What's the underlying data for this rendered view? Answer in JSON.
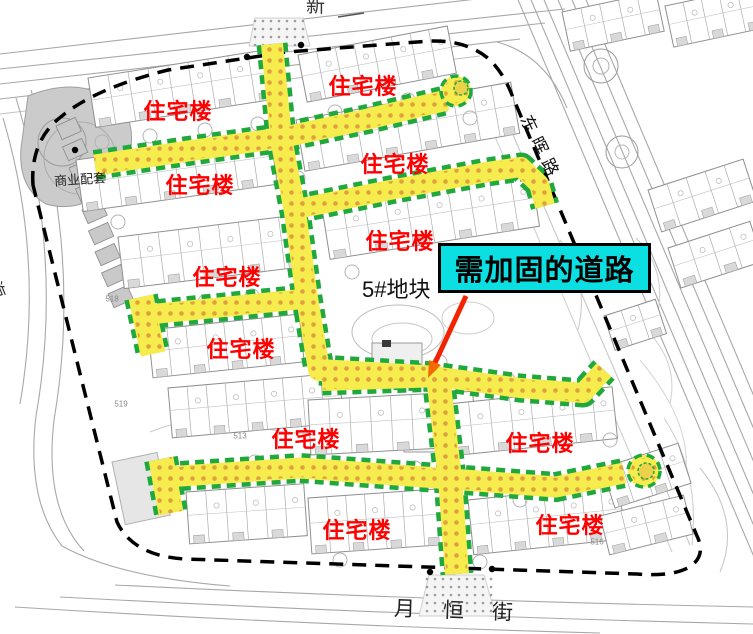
{
  "callout": {
    "label": "需加固的道路",
    "bg": "#0bdfe2",
    "border": "#000000"
  },
  "plot_label": "5#地块",
  "labels": {
    "residential": "住宅楼",
    "residential_color": "#fe0000",
    "residential_positions": [
      [
        178,
        110
      ],
      [
        363,
        85
      ],
      [
        200,
        184
      ],
      [
        395,
        163
      ],
      [
        227,
        276
      ],
      [
        400,
        240
      ],
      [
        241,
        348
      ],
      [
        306,
        438
      ],
      [
        540,
        442
      ],
      [
        357,
        529
      ],
      [
        570,
        524
      ]
    ],
    "commercial": "商业配套",
    "small_labels": [
      {
        "t": "518",
        "x": 112,
        "y": 299
      },
      {
        "t": "519",
        "x": 121,
        "y": 404
      },
      {
        "t": "513",
        "x": 240,
        "y": 436
      },
      {
        "t": "516",
        "x": 597,
        "y": 542
      }
    ]
  },
  "streets": {
    "right": "东晖路",
    "left": "滨海",
    "bottom": "月恒街",
    "top_partial": "新"
  },
  "map": {
    "colors": {
      "road_fill": "#f6ec4e",
      "road_edge": "#1fa83e",
      "road_dot": "#dfa13d",
      "boundary": "#000000",
      "building_stroke": "#8f8f8f",
      "bg_line": "#a8a8a8",
      "arrow": "#f32200",
      "arrow_head": "#f26a00"
    },
    "roads": [
      {
        "d": "M272,44 L281,138 L295,212 L307,298 L319,370 L438,377",
        "w": 22
      },
      {
        "d": "M438,377 L450,478 L457,574",
        "w": 24
      },
      {
        "d": "M95,165 L188,151 L280,138 L368,119 L447,100",
        "w": 21
      },
      {
        "d": "M297,209 L390,190 L487,172 L521,167 L539,184 L545,206",
        "w": 20
      },
      {
        "d": "M143,315 L224,307 L302,299",
        "w": 20
      },
      {
        "d": "M141,297 L153,354",
        "w": 25
      },
      {
        "d": "M322,381 L440,377 L520,388 L583,393 L604,370",
        "w": 20
      },
      {
        "d": "M166,477 L300,468 L438,478 L556,487 L624,473",
        "w": 21
      },
      {
        "d": "M161,459 L171,513",
        "w": 25
      }
    ],
    "bulbs": [
      {
        "cx": 456,
        "cy": 91,
        "r": 15,
        "ix": 461,
        "iy": 88,
        "ir": 7
      },
      {
        "cx": 644,
        "cy": 471,
        "r": 16,
        "ix": 646,
        "iy": 471,
        "ir": 8
      }
    ],
    "rows": [
      [
        88,
        78,
        182,
        50,
        9,
        -9
      ],
      [
        76,
        160,
        196,
        52,
        10,
        -8
      ],
      [
        118,
        237,
        182,
        52,
        9,
        -7
      ],
      [
        148,
        330,
        152,
        48,
        8,
        -6
      ],
      [
        168,
        388,
        172,
        50,
        9,
        -5
      ],
      [
        186,
        492,
        118,
        52,
        6,
        -4
      ],
      [
        308,
        498,
        132,
        56,
        7,
        -4
      ],
      [
        468,
        500,
        152,
        55,
        8,
        -6
      ],
      [
        298,
        55,
        152,
        48,
        8,
        -11
      ],
      [
        296,
        120,
        218,
        52,
        11,
        -10
      ],
      [
        322,
        208,
        212,
        52,
        10,
        -9
      ],
      [
        308,
        400,
        165,
        55,
        8,
        -3
      ],
      [
        448,
        404,
        165,
        52,
        8,
        -6
      ],
      [
        562,
        12,
        96,
        40,
        5,
        -12
      ],
      [
        665,
        6,
        92,
        42,
        5,
        -12
      ],
      [
        648,
        190,
        100,
        44,
        5,
        -18
      ],
      [
        668,
        248,
        86,
        42,
        4,
        -18
      ],
      [
        604,
        316,
        54,
        36,
        3,
        -18
      ],
      [
        602,
        468,
        80,
        42,
        4,
        -18
      ],
      [
        600,
        516,
        86,
        40,
        4,
        -14
      ]
    ],
    "shapes": [
      {
        "t": "path",
        "d": "M28,96 Q88,72 126,112 Q142,150 112,186 Q80,214 46,204 Q18,188 21,148 Z",
        "f": "#cbcbcb",
        "s": "#9e9e9e"
      },
      {
        "t": "circle",
        "cx": 62,
        "cy": 142,
        "r": 24,
        "s": "#9b9b9b"
      },
      {
        "t": "circle",
        "cx": 80,
        "cy": 158,
        "r": 36,
        "s": "#ababab"
      },
      {
        "t": "strip",
        "x": 56,
        "y": 126,
        "n": 9,
        "dx": 6.5,
        "dy": 21,
        "w": 21,
        "h": 15,
        "a": -24,
        "f": "#c9c9c9",
        "s": "#8a8a8a"
      },
      {
        "t": "ellipse",
        "cx": 398,
        "cy": 332,
        "rx": 46,
        "ry": 27,
        "s": "#bdbdbd"
      },
      {
        "t": "ellipse",
        "cx": 402,
        "cy": 339,
        "rx": 30,
        "ry": 16,
        "s": "#c6c6c6"
      },
      {
        "t": "ellipse",
        "cx": 468,
        "cy": 318,
        "rx": 26,
        "ry": 16,
        "s": "#cecece"
      },
      {
        "t": "rect",
        "x": 372,
        "y": 343,
        "w": 50,
        "h": 22,
        "f": "#efefef",
        "s": "#9a9a9a"
      },
      {
        "t": "rect",
        "x": 382,
        "y": 340,
        "w": 9,
        "h": 7,
        "f": "#3a3a3a"
      },
      {
        "t": "rect",
        "x": 404,
        "y": 428,
        "w": 38,
        "h": 24,
        "f": "#f1f1f1",
        "s": "#9a9a9a"
      },
      {
        "t": "circle",
        "cx": 601,
        "cy": 66,
        "r": 17,
        "s": "#9a9a9a"
      },
      {
        "t": "circle",
        "cx": 601,
        "cy": 66,
        "r": 8,
        "s": "#b2b2b2"
      },
      {
        "t": "circle",
        "cx": 622,
        "cy": 152,
        "r": 16,
        "s": "#9a9a9a"
      },
      {
        "t": "circle",
        "cx": 622,
        "cy": 152,
        "r": 7,
        "s": "#b7b7b7"
      },
      {
        "t": "rect",
        "x": 112,
        "y": 462,
        "w": 46,
        "h": 64,
        "f": "#e6e6e6",
        "s": "#b0b0b0",
        "a": -12
      },
      {
        "t": "path",
        "d": "M150,432 Q205,410 255,426 Q300,438 332,430",
        "s": "#c9c9c9"
      }
    ],
    "trees": [
      [
        102,
        142
      ],
      [
        150,
        136
      ],
      [
        205,
        130
      ],
      [
        258,
        124
      ],
      [
        335,
        112
      ],
      [
        408,
        100
      ],
      [
        470,
        118
      ],
      [
        298,
        178
      ],
      [
        252,
        296
      ],
      [
        205,
        302
      ],
      [
        352,
        272
      ],
      [
        300,
        256
      ],
      [
        440,
        362
      ],
      [
        508,
        380
      ],
      [
        560,
        392
      ],
      [
        255,
        462
      ],
      [
        345,
        470
      ],
      [
        480,
        562
      ],
      [
        415,
        468
      ],
      [
        610,
        440
      ],
      [
        118,
        222
      ],
      [
        340,
        560
      ],
      [
        520,
        500
      ]
    ],
    "bg_lines": [
      {
        "d": "M0,99 L520,39"
      },
      {
        "d": "M0,84 L545,23"
      },
      {
        "d": "M0,69 L565,9"
      },
      {
        "d": "M0,54 L520,-6"
      },
      {
        "d": "M0,114 L480,56",
        "c": "#c2c2c2"
      },
      {
        "d": "M497,42 Q545,55 567,108"
      },
      {
        "d": "M516,-5 L768,590"
      },
      {
        "d": "M529,-5 L781,590"
      },
      {
        "d": "M542,-5 L794,590"
      },
      {
        "d": "M556,-5 L808,590"
      },
      {
        "d": "M570,-5 L822,590"
      },
      {
        "d": "M584,-5 L836,590"
      },
      {
        "d": "M498,100 L690,545",
        "c": "#c6c6c6"
      },
      {
        "d": "M482,106 L672,552",
        "c": "#d0d0d0"
      },
      {
        "d": "M115,585 Q420,600 753,607"
      },
      {
        "d": "M60,597 Q420,616 753,624"
      },
      {
        "d": "M15,607 Q300,625 600,633"
      },
      {
        "d": "M16,98 Q64,256 36,416 Q26,500 62,546 Q118,577 230,586"
      },
      {
        "d": "M31,90 Q82,256 54,420 Q44,508 84,551"
      },
      {
        "d": "M3,118 Q45,260 20,404"
      },
      {
        "d": "M338,17 L364,13",
        "c": "#555555",
        "w": 1.5
      },
      {
        "d": "M700,468 Q742,520 720,572",
        "c": "#c9c9c9"
      },
      {
        "d": "M664,418 Q700,472 692,545",
        "c": "#d0d0d0"
      },
      {
        "d": "M640,360 Q690,420 686,470",
        "c": "#d8d8d8"
      },
      {
        "d": "M636,238 Q666,268 658,312",
        "c": "#cfcfcf"
      },
      {
        "d": "M652,336 Q678,366 670,404",
        "c": "#d4d4d4"
      },
      {
        "d": "M560,240 Q590,280 578,330",
        "c": "#cccccc"
      }
    ],
    "boundary": "M33,185 Q30,140 62,116 Q96,88 168,70 L287,52 L430,41 Q468,40 490,60 Q504,74 512,95 L697,536 Q706,555 691,566 Q674,577 637,574 L185,559 Q133,556 117,522 Z",
    "aprons": [
      {
        "pts": "255,18 303,18 310,46 249,46",
        "gx": 255,
        "gy": 21,
        "gw": 52,
        "gh": 24
      },
      {
        "pts": "429,575 484,575 496,616 419,616",
        "gx": 427,
        "gy": 579,
        "gw": 66,
        "gh": 34
      }
    ],
    "bdots": [
      [
        75,
        150
      ],
      [
        247,
        57
      ],
      [
        301,
        45
      ],
      [
        430,
        572
      ],
      [
        492,
        569
      ]
    ],
    "arrow": {
      "x1": 466,
      "y1": 296,
      "x2": 435,
      "y2": 363,
      "head": "428,378 441,365 429,360"
    }
  }
}
